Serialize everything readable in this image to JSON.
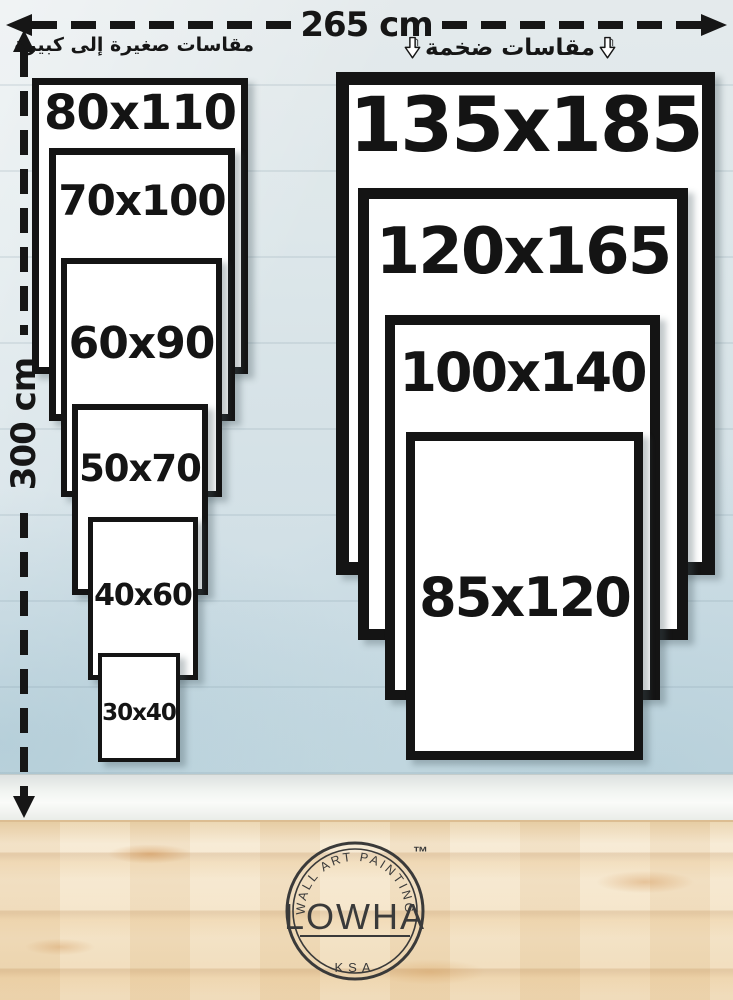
{
  "dimensions": {
    "width_label": "265 cm",
    "height_label": "300 cm"
  },
  "group_labels": {
    "small_to_large_ar": "مقاسات صغيرة إلى كبيرة",
    "huge_ar": "مقاسات ضخمة"
  },
  "sizes_left": [
    "80x110",
    "70x100",
    "60x90",
    "50x70",
    "40x60",
    "30x40"
  ],
  "sizes_right": [
    "135x185",
    "120x165",
    "100x140",
    "85x120"
  ],
  "logo": {
    "arc_text": "WALL ART PAINTING",
    "brand": "LOWHA",
    "country": "KSA",
    "trademark": "™"
  },
  "colors": {
    "ink": "#161616",
    "wall": "#d6e2e7",
    "floor_wood": "#f3e3c9",
    "frame_border": "#141414",
    "frame_fill": "#ffffff"
  }
}
